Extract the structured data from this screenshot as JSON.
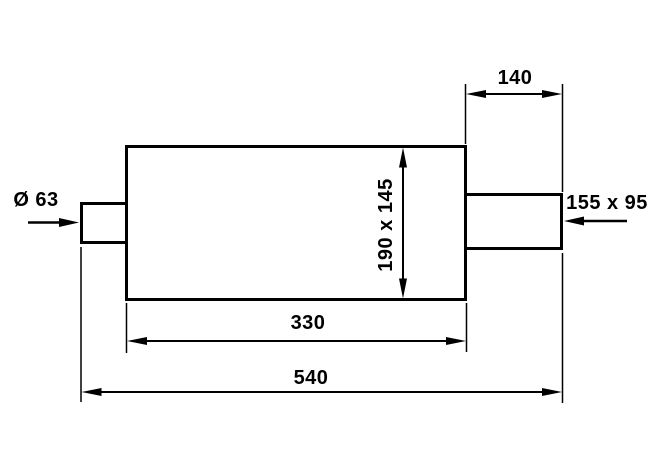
{
  "drawing": {
    "kind": "muffler-dimensional-drawing",
    "background_color": "#ffffff",
    "line_color": "#000000",
    "labels": {
      "inlet_diameter": "Ø 63",
      "outlet_section_length": "140",
      "outlet_size": "155 x 95",
      "body_cross_section": "190 x 145",
      "body_length": "330",
      "overall_length": "540"
    }
  }
}
